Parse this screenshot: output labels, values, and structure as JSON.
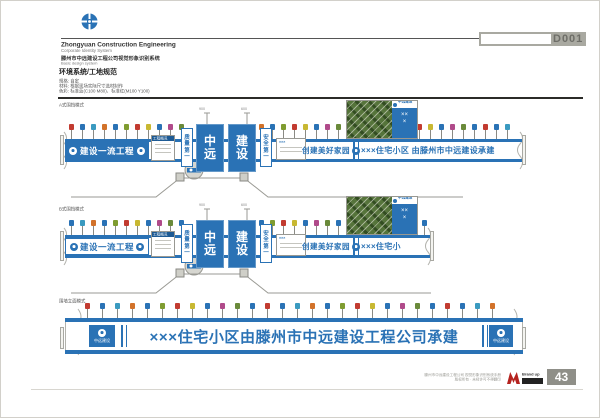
{
  "document": {
    "code": "D001",
    "page_number": "43"
  },
  "header": {
    "company_en": "Zhongyuan Construction Engineering",
    "company_en_sub": "Corporate Identity System",
    "system_cn": "滕州市中远建设工程公司视觉形象识别系统",
    "system_en": "Basic design system",
    "section_title": "环境系统/工地规范",
    "specs": [
      "规格: 自定",
      "材料: 根据现场实际尺寸选材制作",
      "色彩: 标准蓝(C100 M80)、标准红(M100 Y100)"
    ]
  },
  "labels": {
    "a": "A式围挡模式",
    "b": "B式围挡模式",
    "c": "围墙立面模式"
  },
  "fence": {
    "slogan_left": "建设一流工程",
    "slogan_mid": "创建美好家园",
    "gate_left": "中远",
    "gate_right": "建设",
    "strip_left": "质量第一",
    "strip_right": "安全第一",
    "banner_a": "×××住宅小区 由滕州市中远建设承建",
    "banner_b": "×××住宅小",
    "banner_c": "×××住宅小区由滕州市中远建设工程公司承建",
    "brand_short": "中远建设",
    "billboard_side": "×××",
    "info_title": "工程概况",
    "panel2_title": "×××",
    "dim1": "900",
    "dim2": "600"
  },
  "footer": {
    "note1": "滕州市中远建设工程公司 视觉形象识别系统手册",
    "note2": "版权所有 · 未经许可不得翻印",
    "brand_name": "Brand up",
    "brand_name_cn": "兆维品牌"
  },
  "colors": {
    "brand_blue": "#2a72b5",
    "dark_blue": "#1d5a94",
    "accent_red": "#b5231f",
    "flag_cycle": [
      "#c23b30",
      "#2a72b5",
      "#3a9ac0",
      "#d2722a",
      "#2a72b5",
      "#7f9c30",
      "#c23b30",
      "#c8b832",
      "#2a72b5",
      "#b04a8a",
      "#6a8a3a",
      "#2a72b5"
    ]
  }
}
